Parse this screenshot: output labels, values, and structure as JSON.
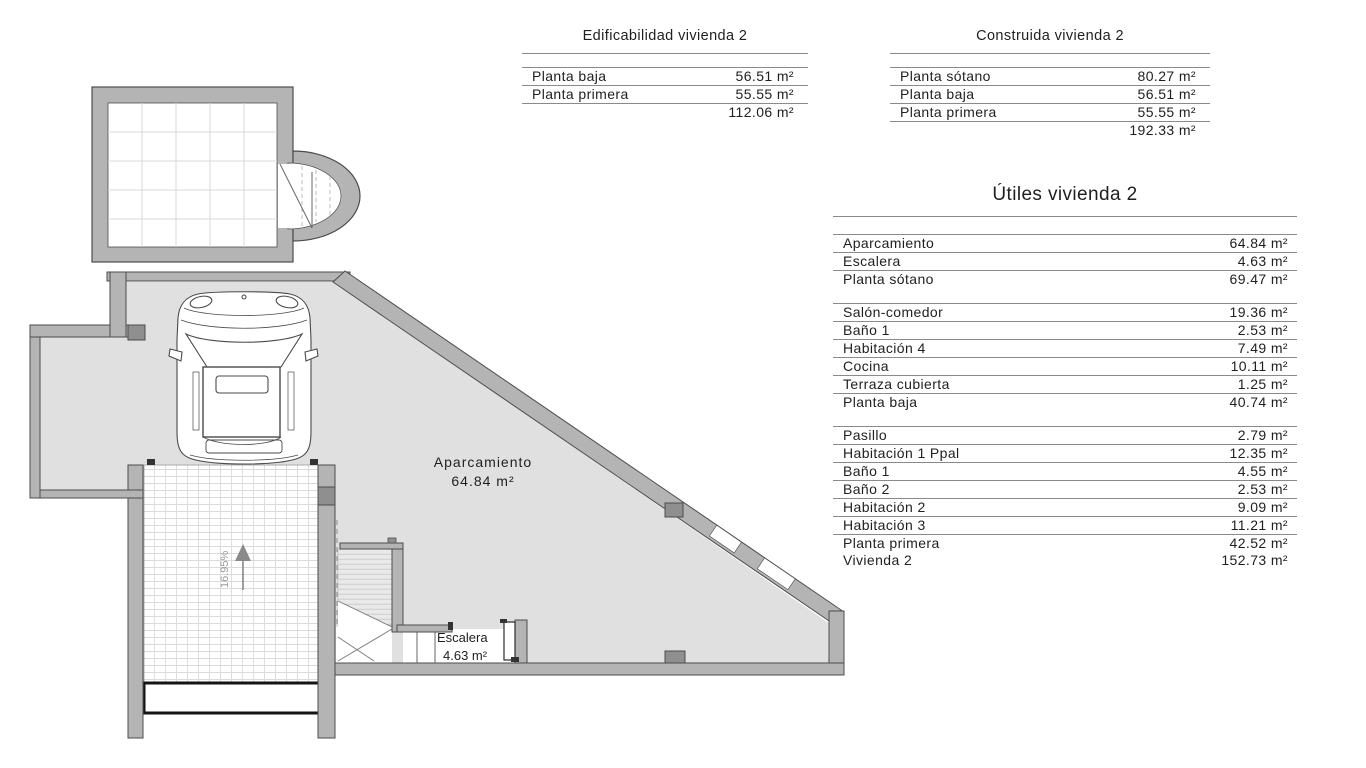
{
  "plan": {
    "labels": {
      "aparcamiento_name": "Aparcamiento",
      "aparcamiento_area": "64.84 m²",
      "escalera_name": "Escalera",
      "escalera_area": "4.63 m²",
      "ramp_slope": "16.95%"
    },
    "colors": {
      "wall": "#b4b4b4",
      "wall_dark": "#8f8f8f",
      "floor": "#e0e0e0",
      "outline": "#4d4d4d"
    }
  },
  "tables": {
    "edificabilidad": {
      "title": "Edificabilidad vivienda 2",
      "rows": [
        {
          "label": "Planta baja",
          "value": "56.51 m²"
        },
        {
          "label": "Planta primera",
          "value": "55.55 m²"
        }
      ],
      "total": "112.06 m²"
    },
    "construida": {
      "title": "Construida vivienda 2",
      "rows": [
        {
          "label": "Planta sótano",
          "value": "80.27 m²"
        },
        {
          "label": "Planta baja",
          "value": "56.51 m²"
        },
        {
          "label": "Planta primera",
          "value": "55.55 m²"
        }
      ],
      "total": "192.33 m²"
    },
    "utiles": {
      "title": "Útiles vivienda 2",
      "groups": [
        {
          "rows": [
            {
              "label": "Aparcamiento",
              "value": "64.84 m²"
            },
            {
              "label": "Escalera",
              "value": "4.63 m²"
            },
            {
              "label": "Planta sótano",
              "value": "69.47 m²"
            }
          ]
        },
        {
          "rows": [
            {
              "label": "Salón-comedor",
              "value": "19.36 m²"
            },
            {
              "label": "Baño 1",
              "value": "2.53 m²"
            },
            {
              "label": "Habitación 4",
              "value": "7.49 m²"
            },
            {
              "label": "Cocina",
              "value": "10.11 m²"
            },
            {
              "label": "Terraza cubierta",
              "value": "1.25 m²"
            },
            {
              "label": "Planta baja",
              "value": "40.74 m²"
            }
          ]
        },
        {
          "rows": [
            {
              "label": "Pasillo",
              "value": "2.79 m²"
            },
            {
              "label": "Habitación 1 Ppal",
              "value": "12.35 m²"
            },
            {
              "label": "Baño 1",
              "value": "4.55 m²"
            },
            {
              "label": "Baño 2",
              "value": "2.53 m²"
            },
            {
              "label": "Habitación 2",
              "value": "9.09 m²"
            },
            {
              "label": "Habitación 3",
              "value": "11.21 m²"
            },
            {
              "label": "Planta primera",
              "value": "42.52 m²"
            },
            {
              "label": "Vivienda 2",
              "value": "152.73 m²"
            }
          ]
        }
      ]
    }
  }
}
